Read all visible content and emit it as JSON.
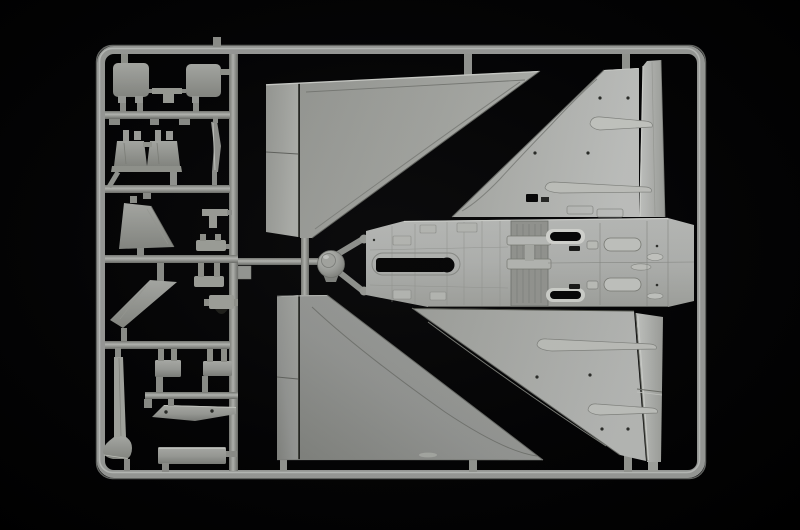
{
  "scene": {
    "type": "photograph",
    "subject": "plastic model kit sprue",
    "description": "Light grey injection-moulded sprue (runner frame) of an aircraft model kit photographed on a black background. Large delta wing halves, a one-piece fuselage underside, a radome cone and many small parts are attached to the rectangular frame.",
    "orientation": "landscape"
  },
  "colors": {
    "background": "#030304",
    "frame_bar": "#a7a9a6",
    "frame_edge": "#6e706d",
    "frame_highlight": "#ced0cd",
    "plastic_base": "#b2b4b1",
    "plastic_bright": "#cdcfcc",
    "plastic_highlight": "#e6e8e5",
    "plastic_shadow": "#8b8d8a",
    "seam_dark": "#55574f",
    "slot_black": "#070708"
  },
  "sprue": {
    "frame": "rectangular runner frame with rounded corners",
    "parts": [
      {
        "id": "upper-wing-left",
        "label": "upper wing half (left)"
      },
      {
        "id": "upper-wing-right",
        "label": "upper wing half (right)"
      },
      {
        "id": "lower-wing-left",
        "label": "lower wing half (left)"
      },
      {
        "id": "lower-wing-right",
        "label": "lower wing half (right)"
      },
      {
        "id": "fuselage-underside",
        "label": "fuselage centre section"
      },
      {
        "id": "fin-upper",
        "label": "tall fin strip (upper)"
      },
      {
        "id": "fin-lower",
        "label": "tall fin strip (lower)"
      },
      {
        "id": "radome-cone",
        "label": "radome cone"
      },
      {
        "id": "hatch-left",
        "label": "rounded hatch panel (left)"
      },
      {
        "id": "hatch-right",
        "label": "rounded hatch panel (right)"
      },
      {
        "id": "ejection-seat-1",
        "label": "ejection seat"
      },
      {
        "id": "ejection-seat-2",
        "label": "ejection seat"
      },
      {
        "id": "canopy-blade",
        "label": "thin curved blade"
      },
      {
        "id": "tail-fin-half-a",
        "label": "tail fin half"
      },
      {
        "id": "tail-fin-half-b",
        "label": "tail fin half"
      },
      {
        "id": "avionics-box-a",
        "label": "small box part"
      },
      {
        "id": "avionics-box-b",
        "label": "small box part"
      },
      {
        "id": "pylon-rail",
        "label": "tapered pylon rail"
      },
      {
        "id": "tank-board",
        "label": "long rectangular part"
      },
      {
        "id": "probe-blade",
        "label": "tall blade with curved foot"
      },
      {
        "id": "small-brackets",
        "label": "assorted small brackets"
      }
    ]
  }
}
